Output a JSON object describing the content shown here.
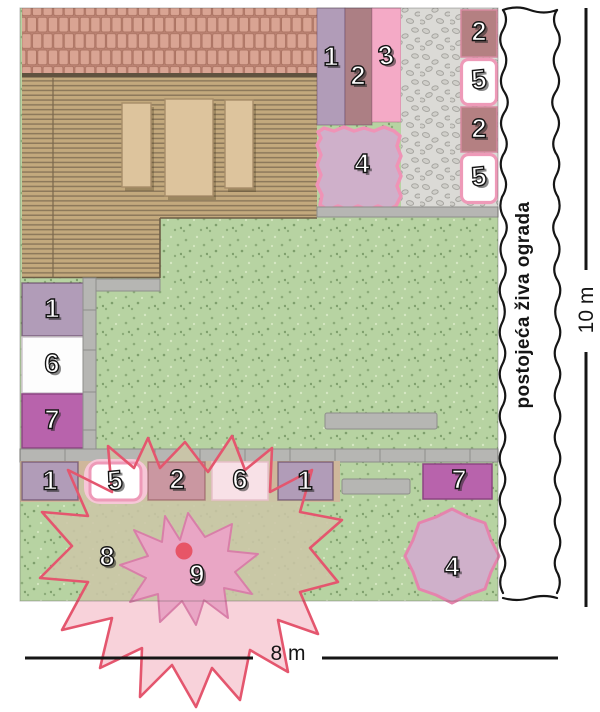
{
  "labels": {
    "hedge": "postojeća živa ograda",
    "height_dim": "10 m",
    "width_dim": "8 m"
  },
  "zones": [
    {
      "id": "bed-1-top",
      "label": "1"
    },
    {
      "id": "bed-2-top",
      "label": "2"
    },
    {
      "id": "bed-3-top",
      "label": "3"
    },
    {
      "id": "bed-4-top",
      "label": "4"
    },
    {
      "id": "bed-2-right-a",
      "label": "2"
    },
    {
      "id": "bed-5-right-a",
      "label": "5"
    },
    {
      "id": "bed-2-right-b",
      "label": "2"
    },
    {
      "id": "bed-5-right-b",
      "label": "5"
    },
    {
      "id": "bed-1-left",
      "label": "1"
    },
    {
      "id": "bed-6-left",
      "label": "6"
    },
    {
      "id": "bed-7-left",
      "label": "7"
    },
    {
      "id": "bed-1-bottom-a",
      "label": "1"
    },
    {
      "id": "bed-5-bottom",
      "label": "5"
    },
    {
      "id": "bed-2-bottom",
      "label": "2"
    },
    {
      "id": "bed-6-bottom",
      "label": "6"
    },
    {
      "id": "bed-1-bottom-b",
      "label": "1"
    },
    {
      "id": "bed-7-bottom",
      "label": "7"
    },
    {
      "id": "canopy-8",
      "label": "8"
    },
    {
      "id": "plant-9",
      "label": "9"
    },
    {
      "id": "bed-4-bottom",
      "label": "4"
    }
  ],
  "colors": {
    "zone1": "#b19cb8",
    "zone2": "#b48082",
    "zone2_band": "#ac7f84",
    "zone2_light": "#ca97a1",
    "zone3": "#f4aac6",
    "zone4": "#cfb0ca",
    "zone4_border": "#ef93b6",
    "zone5_border": "#ee9ab8",
    "zone5_halo": "#f6c7d7",
    "zone6_left": "#fdfdfd",
    "zone6_bottom": "#f8e1e7",
    "zone7": "#b863ac",
    "area8_beige": "#cbc5a7",
    "area8_pink": "#f8d2da",
    "area8_outline": "#e4566e",
    "plant9_fill": "#e9a6c5",
    "plant9_stroke": "#d87fa8",
    "plant9_dot": "#e75567",
    "lawn": "#b7d3a2",
    "deck": "#c3a97d",
    "roof": "#d9a493",
    "paving": "#dbdad6",
    "slab": "#b6b6b3",
    "tan_bed": "#cfb79b"
  }
}
